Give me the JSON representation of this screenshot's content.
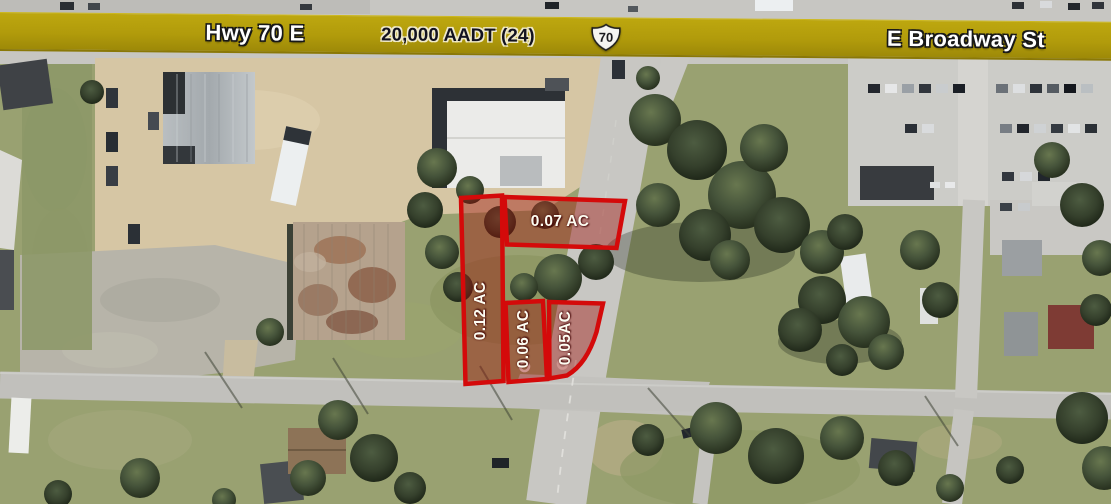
{
  "banner": {
    "highway_label": "Hwy 70 E",
    "traffic_count": "20,000 AADT (24)",
    "route_shield": "70",
    "street_label": "E Broadway St"
  },
  "parcels": [
    {
      "label": "0.07 AC"
    },
    {
      "label": "0.12 AC"
    },
    {
      "label": "0.06 AC"
    },
    {
      "label": "0.05AC"
    }
  ],
  "colors": {
    "parcel_outline": "#D40A0A",
    "parcel_fill": "rgba(158,16,10,0.42)",
    "banner_gold": "#B19B0B"
  }
}
